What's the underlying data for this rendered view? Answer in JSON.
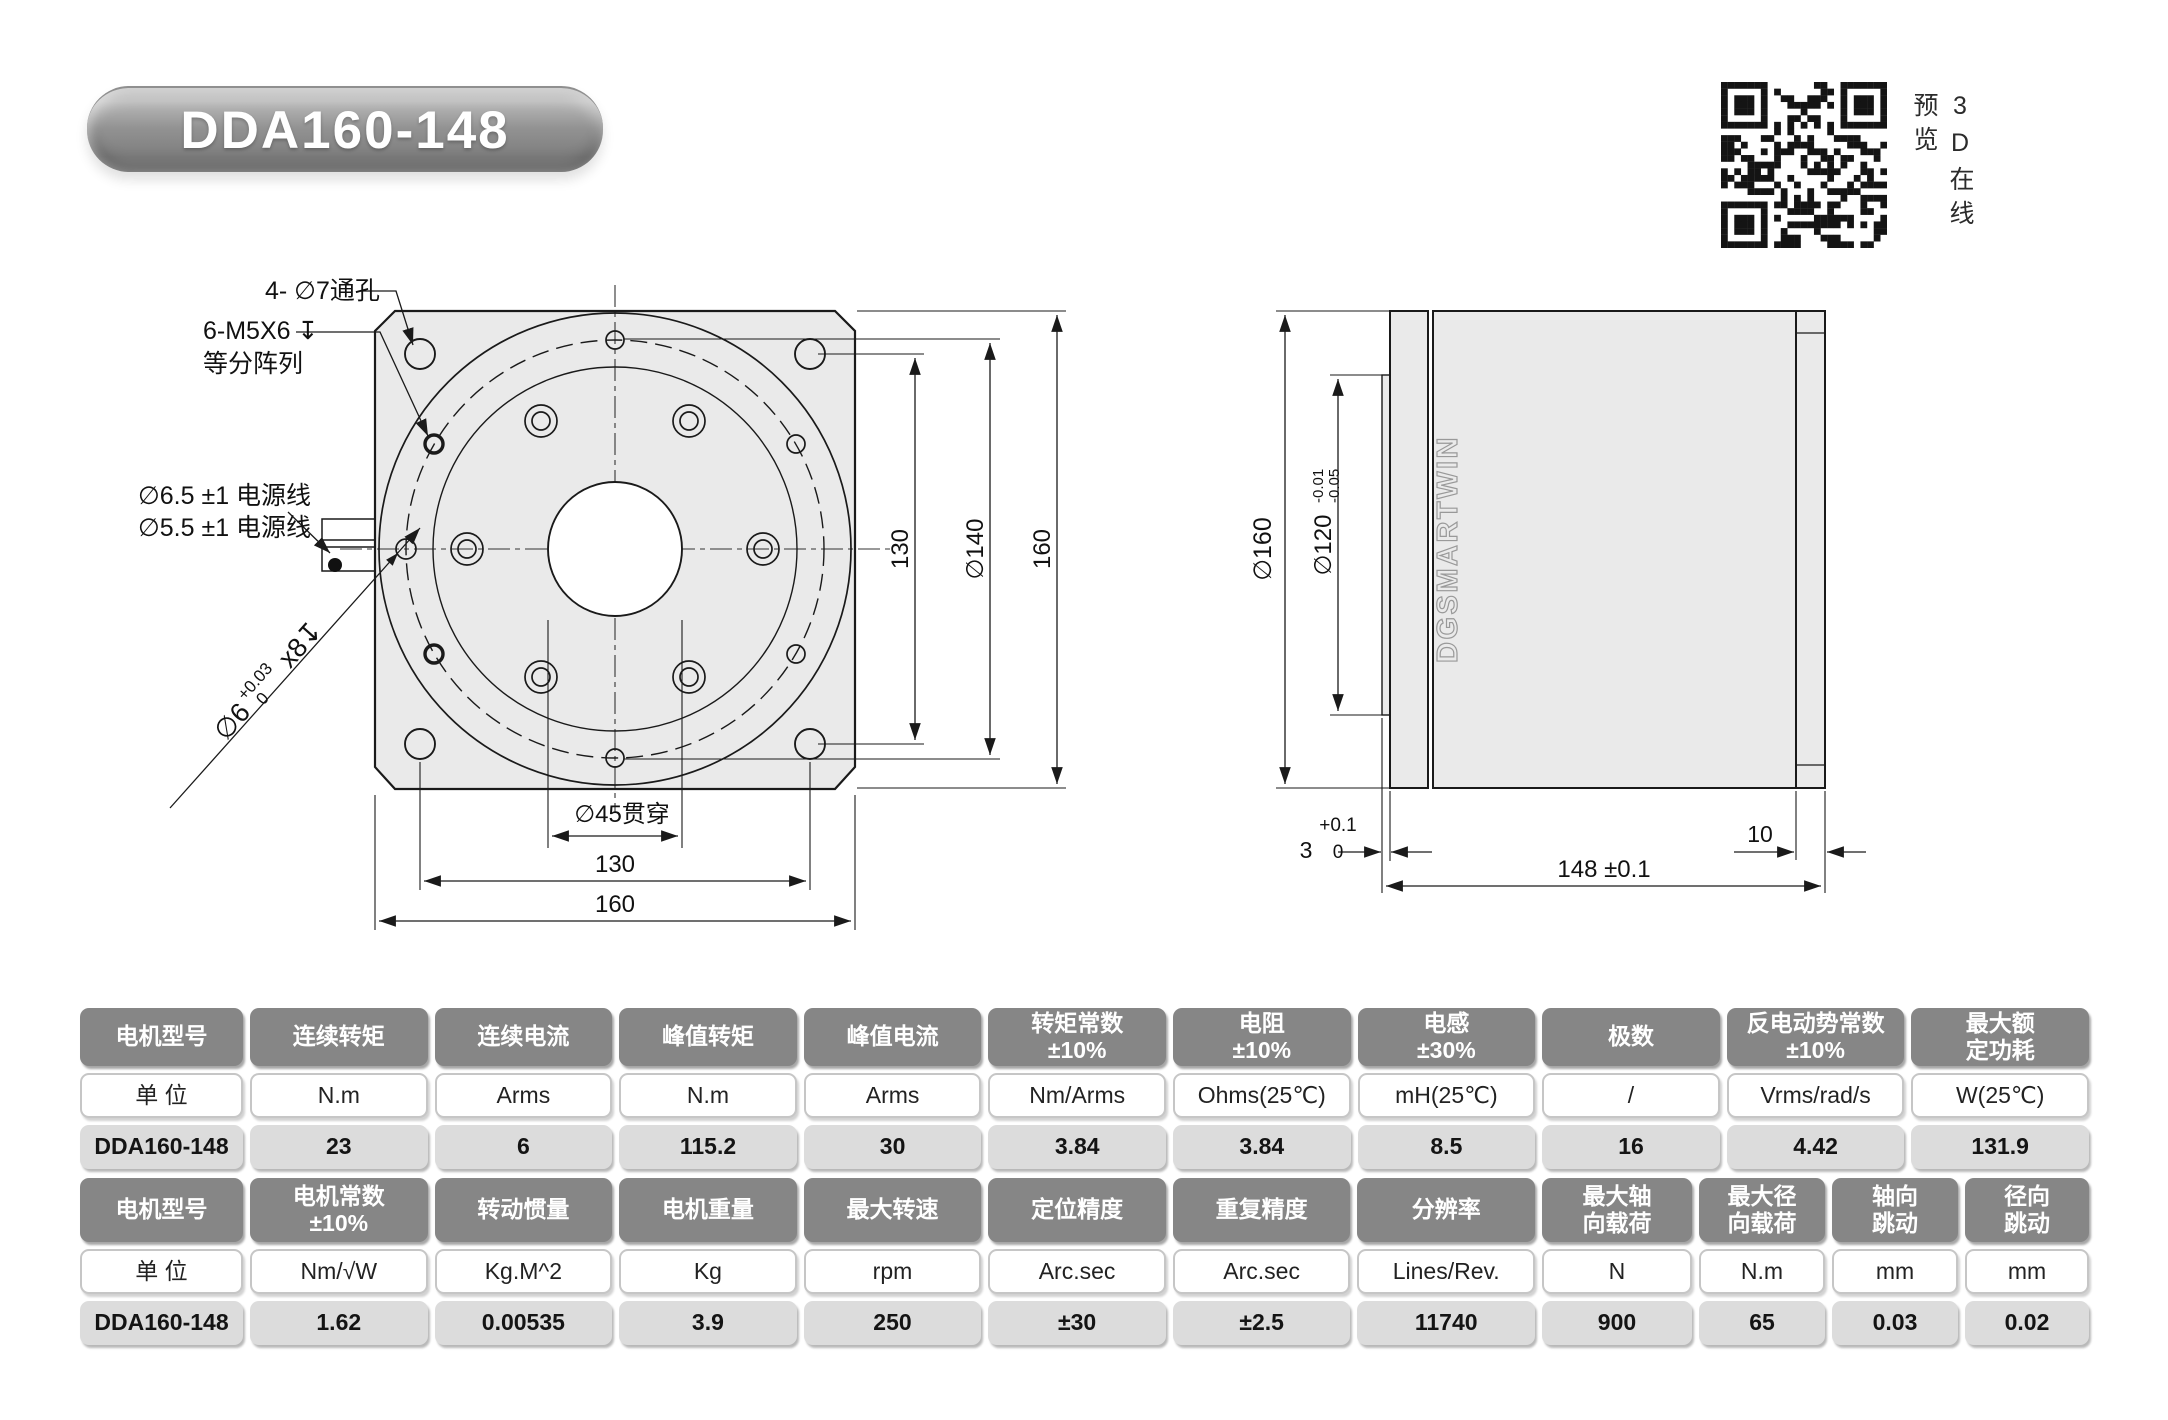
{
  "title": "DDA160-148",
  "qr_caption": "3D在线预览",
  "accent_colors": {
    "table_header_bg": "#868686",
    "table_value_bg": "#dcdcdc",
    "drawing_fill": "#eaeaea",
    "line_color": "#1a1a1a"
  },
  "front_view": {
    "label_corner_holes": "4- ∅7通孔",
    "label_tapped_line1": "6-M5X6 ↧",
    "label_tapped_line2": "等分阵列",
    "label_cable_1": "∅6.5 ±1 电源线",
    "label_cable_2": "∅5.5 ±1 电源线",
    "label_pin_dia": "∅6",
    "label_pin_tol_up": "+0.03",
    "label_pin_tol_low": "0",
    "label_pin_count": "x8↧",
    "dim_center_hole": "∅45贯穿",
    "dim_bottom_inner": "130",
    "dim_bottom_outer": "160",
    "dim_right_inner": "130",
    "dim_right_mid": "∅140",
    "dim_right_outer": "160"
  },
  "side_view": {
    "dim_dia_outer": "∅160",
    "dim_dia_pilot": "∅120",
    "pilot_tol_up": "-0.01",
    "pilot_tol_low": "-0.05",
    "boss_nominal": "3",
    "boss_tol_up": "+0.1",
    "boss_tol_low": "0",
    "dim_rear": "10",
    "dim_length": "148 ±0.1",
    "body_brand": "DGSMARTWIN"
  },
  "spec_table_1": {
    "headers": [
      "电机型号",
      "连续转矩",
      "连续电流",
      "峰值转矩",
      "峰值电流",
      "转矩常数\n±10%",
      "电阻\n±10%",
      "电感\n±30%",
      "极数",
      "反电动势常数\n±10%",
      "最大额\n定功耗"
    ],
    "units": [
      "单 位",
      "N.m",
      "Arms",
      "N.m",
      "Arms",
      "Nm/Arms",
      "Ohms(25℃)",
      "mH(25℃)",
      "/",
      "Vrms/rad/s",
      "W(25℃)"
    ],
    "values": [
      "DDA160-148",
      "23",
      "6",
      "115.2",
      "30",
      "3.84",
      "3.84",
      "8.5",
      "16",
      "4.42",
      "131.9"
    ]
  },
  "spec_table_2": {
    "headers": [
      "电机型号",
      "电机常数\n±10%",
      "转动惯量",
      "电机重量",
      "最大转速",
      "定位精度",
      "重复精度",
      "分辨率",
      "最大轴\n向载荷",
      "最大径\n向载荷",
      "轴向\n跳动",
      "径向\n跳动"
    ],
    "units": [
      "单 位",
      "Nm/√W",
      "Kg.M^2",
      "Kg",
      "rpm",
      "Arc.sec",
      "Arc.sec",
      "Lines/Rev.",
      "N",
      "N.m",
      "mm",
      "mm"
    ],
    "values": [
      "DDA160-148",
      "1.62",
      "0.00535",
      "3.9",
      "250",
      "±30",
      "±2.5",
      "11740",
      "900",
      "65",
      "0.03",
      "0.02"
    ]
  }
}
